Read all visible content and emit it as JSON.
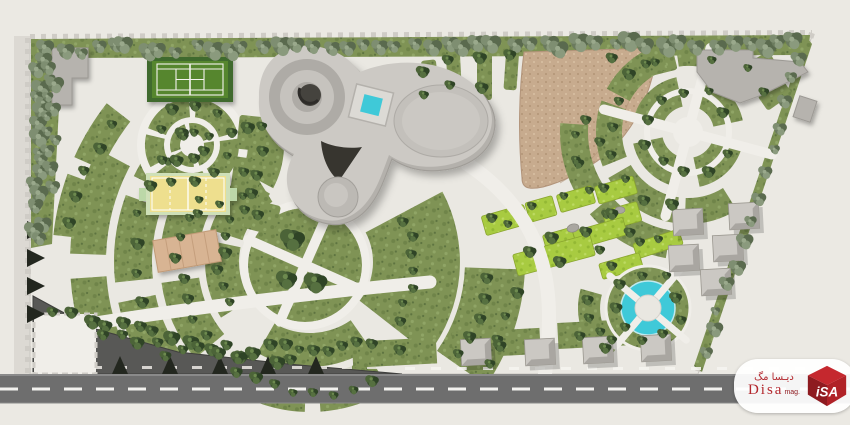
{
  "watermark": {
    "brand": "Disa",
    "brand_suffix": "mag.",
    "arabic_title": "دیـسا مگ",
    "logo_text": "iSA",
    "logo_name": "isa-cube-logo"
  },
  "palette": {
    "background": "#ebe9e3",
    "park_ground": "#eae8e2",
    "path": "#f0eee9",
    "lawn": "#7f9355",
    "lawn_bright": "#a8cb41",
    "foliage_dark": "#3c5230",
    "foliage_muted": "#6b7b5e",
    "water": "#3fc9d8",
    "paving_tan": "#c7ab8e",
    "building_gray": "#c6c3be",
    "road": "#6e6e6e",
    "parking": "#585856",
    "court_tennis": "#57862f",
    "court_volleyball": "#eedf8e",
    "deck_wood": "#d8b493",
    "brand_red": "#b3272d"
  },
  "features": [
    "perimeter tree border",
    "tennis court",
    "volleyball court",
    "circular shrub plaza",
    "timber deck",
    "central pavilion building",
    "turquoise skylight pool",
    "spiral ramp",
    "roof dome",
    "paved fan plaza",
    "circular crossing plaza",
    "terraced planters",
    "circular fountain",
    "kiosk cubes",
    "parking area",
    "entrance plaza",
    "street"
  ]
}
